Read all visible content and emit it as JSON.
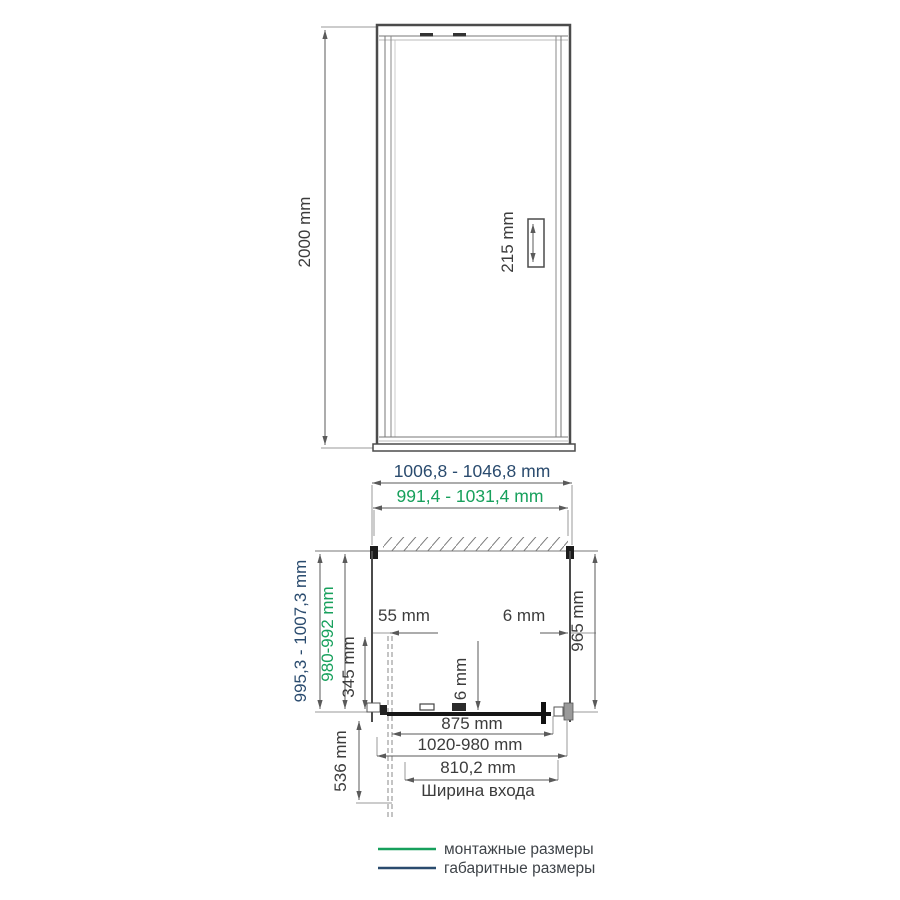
{
  "colors": {
    "mounting_green": "#17a05c",
    "overall_navy": "#2a4b6e",
    "text_dark": "#3c3c3c",
    "legend_text": "#3f4449"
  },
  "front_view": {
    "height_label": "2000 mm",
    "handle_height_label": "215 mm"
  },
  "plan_view": {
    "overall_width_label": "1006,8 - 1046,8 mm",
    "mounting_width_label": "991,4 - 1031,4 mm",
    "overall_depth_label": "995,3 - 1007,3 mm",
    "mounting_depth_label": "980-992 mm",
    "wall_offset_label": "55 mm",
    "right_gap_label": "6 mm",
    "inner_depth_label": "965 mm",
    "side_segment_label": "345 mm",
    "glass_thickness_label": "6 mm",
    "door_glass_width_label": "875 mm",
    "adjustment_range_label": "1020-980 mm",
    "entrance_width_label": "810,2 mm",
    "entrance_caption": "Ширина входа",
    "door_swing_label": "536 mm"
  },
  "legend": {
    "items": [
      {
        "label": "монтажные размеры"
      },
      {
        "label": "габаритные размеры"
      }
    ]
  }
}
